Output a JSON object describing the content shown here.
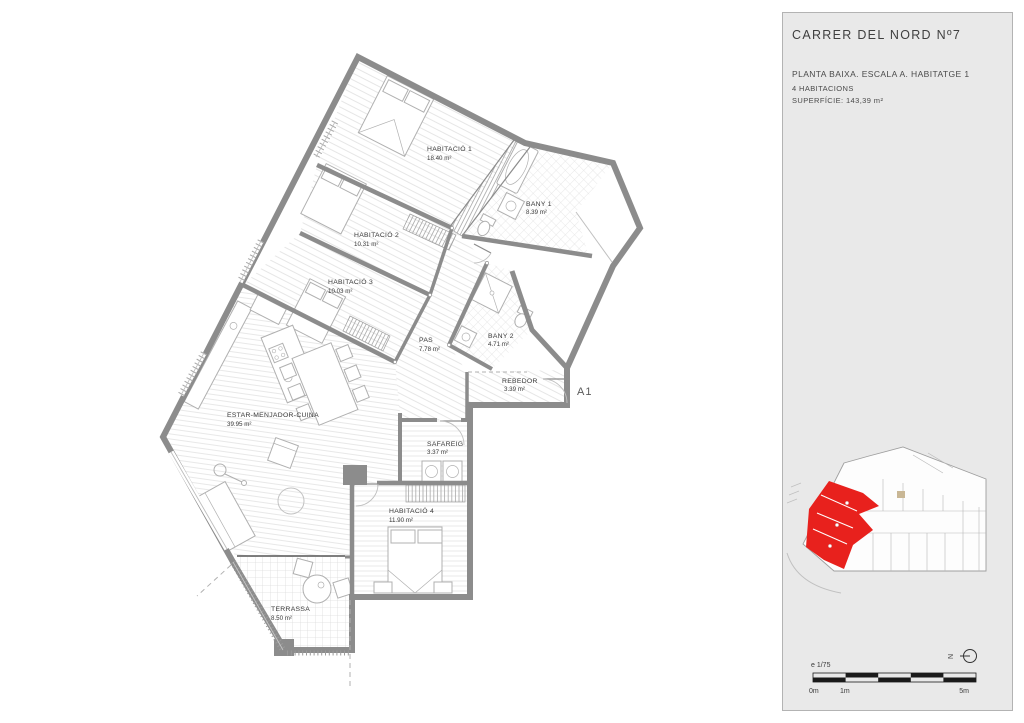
{
  "project": {
    "title": "CARRER DEL NORD Nº7",
    "plan_line": "PLANTA BAIXA. ESCALA A. HABITATGE 1",
    "rooms_line": "4 HABITACIONS",
    "surface_line": "SUPERFÍCIE: 143,39 m²"
  },
  "plan": {
    "entrance_label": "A1",
    "rooms": [
      {
        "name": "HABITACIÓ 1",
        "area": "18.40 m²"
      },
      {
        "name": "BANY 1",
        "area": "8.39 m²"
      },
      {
        "name": "HABITACIÓ 2",
        "area": "10.31 m²"
      },
      {
        "name": "HABITACIÓ 3",
        "area": "10.03 m²"
      },
      {
        "name": "PAS",
        "area": "7.78 m²"
      },
      {
        "name": "BANY 2",
        "area": "4.71 m²"
      },
      {
        "name": "REBEDOR",
        "area": "3.39 m²"
      },
      {
        "name": "ESTAR-MENJADOR-CUINA",
        "area": "39.95 m²"
      },
      {
        "name": "SAFAREIG",
        "area": "3.37 m²"
      },
      {
        "name": "HABITACIÓ 4",
        "area": "11.90 m²"
      },
      {
        "name": "TERRASSA",
        "area": "8.50 m²"
      }
    ]
  },
  "scale_bar": {
    "scale_label": "e 1/75",
    "tick_0": "0m",
    "tick_1": "1m",
    "tick_5": "5m"
  },
  "north": {
    "label": "N"
  },
  "colors": {
    "unit_highlight": "#e8211d",
    "sidebar_bg": "#e9e9e9",
    "wall": "#8c8c8c"
  }
}
